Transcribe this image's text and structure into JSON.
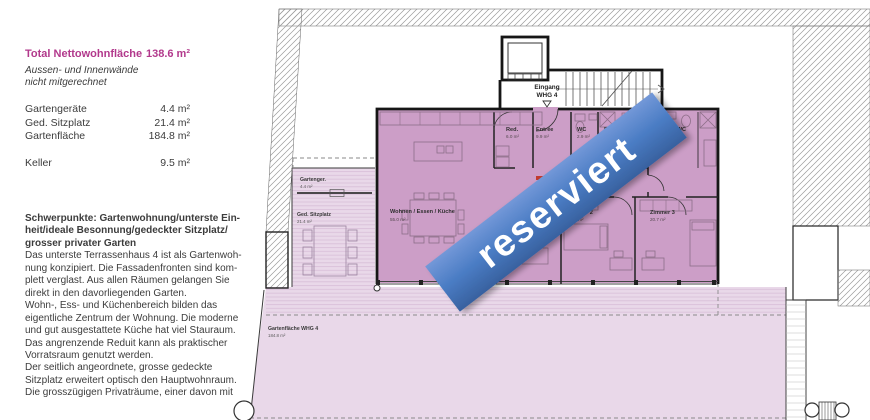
{
  "info_panel": {
    "title": {
      "label": "Total Nettowohnfläche",
      "value": "138.6 m²"
    },
    "note_lines": [
      "Aussen- und Innenwände",
      "nicht mitgerechnet"
    ],
    "area_rows": [
      {
        "label": "Gartengeräte",
        "value": "4.4 m²"
      },
      {
        "label": "Ged. Sitzplatz",
        "value": "21.4 m²"
      },
      {
        "label": "Gartenfläche",
        "value": "184.8 m²"
      },
      {
        "label": "Keller",
        "value": "9.5 m²"
      }
    ],
    "description_lines": [
      "Schwerpunkte: Gartenwohnung/unterste Ein-",
      "heit/ideale Besonnung/gedeckter Sitzplatz/",
      "grosser privater Garten",
      "Das unterste Terrassenhaus 4 ist als Gartenwoh-",
      "nung konzipiert. Die Fassadenfronten sind kom-",
      "plett verglast. Aus allen Räumen gelangen Sie",
      "direkt in den davorliegenden Garten.",
      "Wohn-, Ess- und Küchenbereich bilden das",
      "eigentliche Zentrum der Wohnung. Die moderne",
      "und gut ausgestattete Küche hat viel Stauraum.",
      "Das angrenzende Reduit kann als praktischer",
      "Vorratsraum genutzt werden.",
      "Der seitlich angeordnete, grosse gedeckte",
      "Sitzplatz erweitert optisch den Hauptwohnraum.",
      "Die grosszügigen Privaträume, einer davon mit"
    ]
  },
  "plan": {
    "entrance": {
      "line1": "Eingang",
      "line2": "WHG 4"
    },
    "rooms": {
      "wohnen": {
        "name": "Wohnen / Essen / Küche",
        "area": "55.0 m²"
      },
      "reduit": {
        "name": "Red.",
        "area": "6.0 m²"
      },
      "entree": {
        "name": "Entrée",
        "area": "9.9 m²"
      },
      "wc": {
        "name": "WC",
        "area": "2.9 m²"
      },
      "du_wc_1": {
        "name": "DU / WC",
        "area": ""
      },
      "du_wc_2": {
        "name": "DU / WC",
        "area": "6.1 m²"
      },
      "zimmer2": {
        "name": "Zimmer 2",
        "area": "13.2 m²"
      },
      "zimmer3": {
        "name": "Zimmer 3",
        "area": "20.7 m²"
      }
    },
    "outdoor": {
      "gartengeraete": {
        "name": "Gartenger.",
        "area": "4.4 m²"
      },
      "sitzplatz": {
        "name": "Ged. Sitzplatz",
        "area": "21.4 m²"
      },
      "gartenflaeche": {
        "name": "Gartenfläche WHG 4",
        "area": "184.8 m²"
      }
    },
    "banner": {
      "text": "reserviert"
    }
  },
  "colors": {
    "accent_magenta": "#b2398c",
    "banner_blue": "#4a7cc4",
    "room_fill": "#cc9ec7",
    "garden_fill": "#e9d8e9"
  }
}
